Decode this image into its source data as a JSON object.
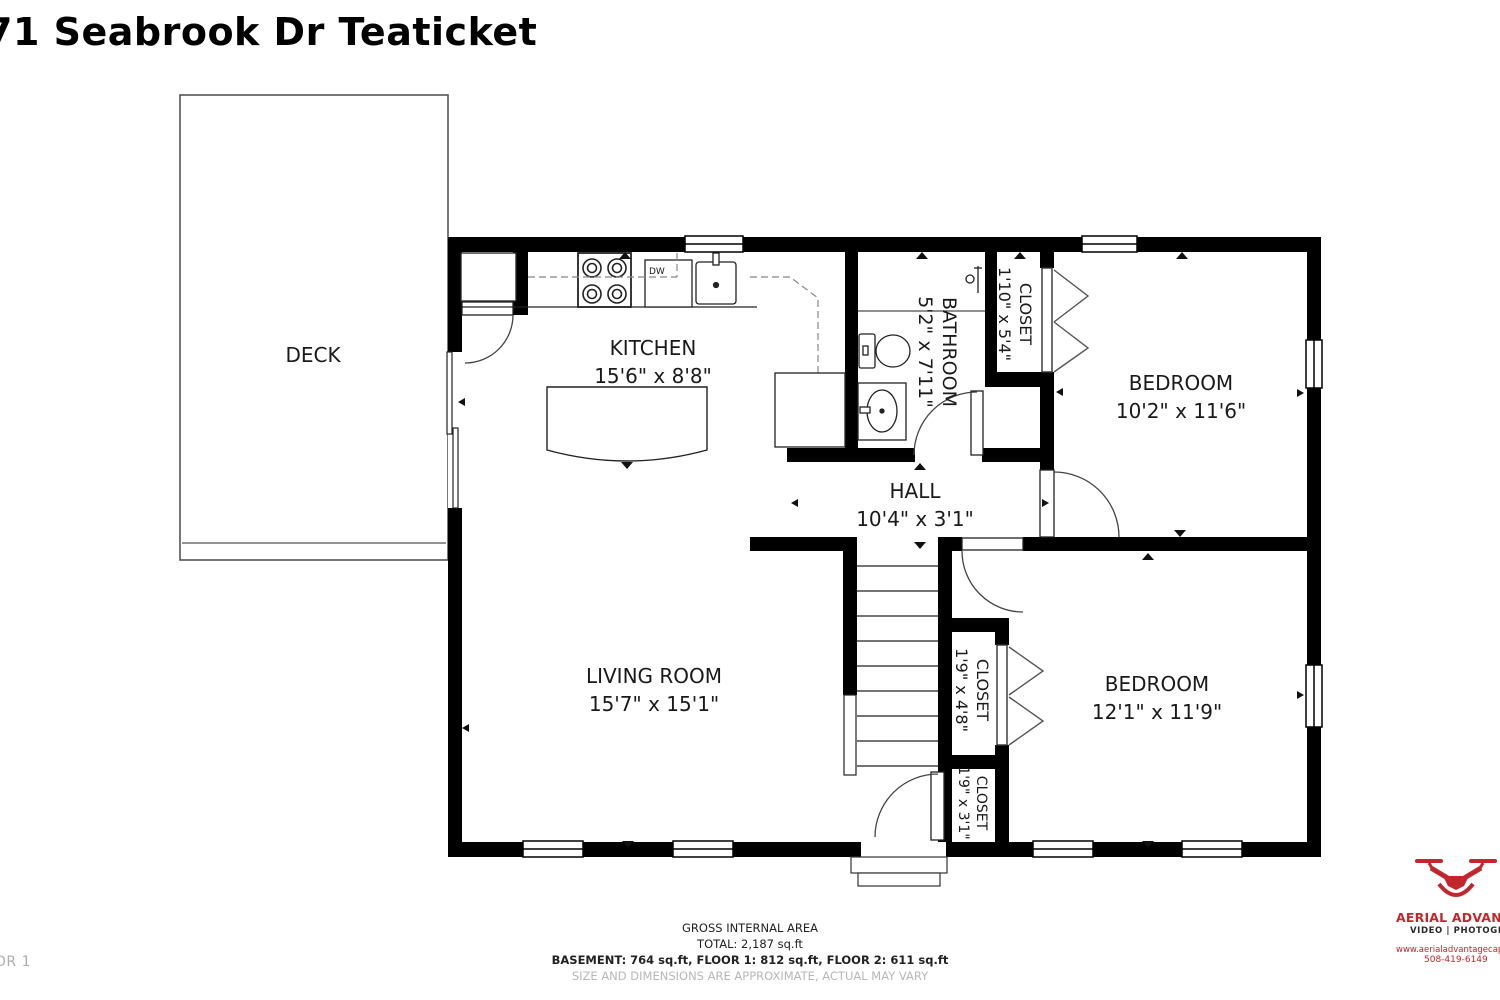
{
  "page": {
    "title": "71 Seabrook Dr Teaticket",
    "floor_label": "FLOOR 1"
  },
  "rooms": {
    "deck": {
      "name": "DECK",
      "dims": ""
    },
    "kitchen": {
      "name": "KITCHEN",
      "dims": "15'6\" x 8'8\""
    },
    "bathroom": {
      "name": "BATHROOM",
      "dims": "5'2\" x 7'11\""
    },
    "closet_top": {
      "name": "CLOSET",
      "dims": "1'10\" x 5'4\""
    },
    "bedroom_upper": {
      "name": "BEDROOM",
      "dims": "10'2\" x 11'6\""
    },
    "hall": {
      "name": "HALL",
      "dims": "10'4\" x 3'1\""
    },
    "living_room": {
      "name": "LIVING ROOM",
      "dims": "15'7\" x 15'1\""
    },
    "closet_mid": {
      "name": "CLOSET",
      "dims": "1'9\" x 4'8\""
    },
    "closet_lower": {
      "name": "CLOSET",
      "dims": "1'9\" x 3'1\""
    },
    "bedroom_lower": {
      "name": "BEDROOM",
      "dims": "12'1\" x 11'9\""
    }
  },
  "labels": {
    "dishwasher": "DW"
  },
  "footer": {
    "line1": "GROSS INTERNAL AREA",
    "line2": "TOTAL: 2,187 sq.ft",
    "line3": "BASEMENT: 764 sq.ft, FLOOR 1: 812 sq.ft, FLOOR 2: 611 sq.ft",
    "disclaimer": "SIZE AND DIMENSIONS ARE APPROXIMATE, ACTUAL MAY VARY"
  },
  "branding": {
    "company": "AERIAL ADVANTAGE",
    "tagline": "VIDEO | PHOTOGRAPHY",
    "website": "www.aerialadvantagecapeco",
    "phone": "508-419-6149",
    "accent_color": "#c1272d"
  },
  "colors": {
    "wall": "#000000",
    "thin_line": "#333333",
    "muted_text": "#b7b7b7"
  }
}
